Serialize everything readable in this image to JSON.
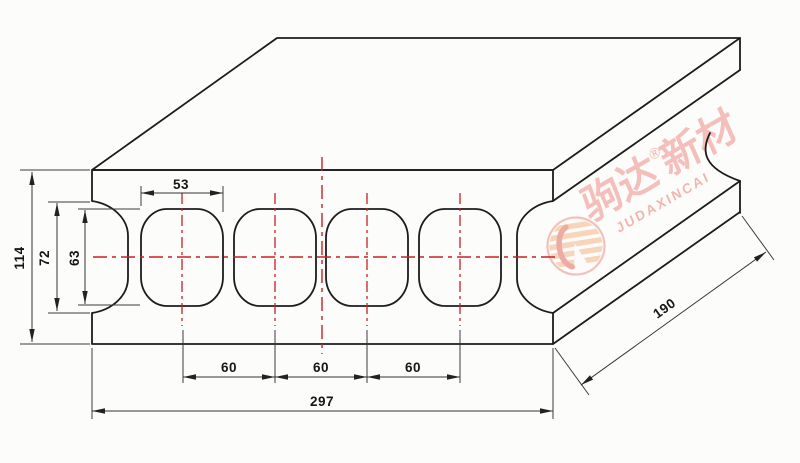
{
  "dims": {
    "panel_thickness": "114",
    "edge_groove_height": "72",
    "core_hole_height": "63",
    "core_hole_width": "53",
    "core_spacing": [
      "60",
      "60",
      "60"
    ],
    "panel_width": "297",
    "panel_depth": "190"
  },
  "watermark": {
    "brand_cn_left": "驹达",
    "registered_mark": "®",
    "brand_cn_right": "新材",
    "brand_en": "JUDAXINCAI"
  },
  "colors": {
    "outline": "#1c1c1c",
    "dimension_lines": "#3a3a3a",
    "centerline_red": "#c92020",
    "watermark_red": "#ef8f88"
  }
}
